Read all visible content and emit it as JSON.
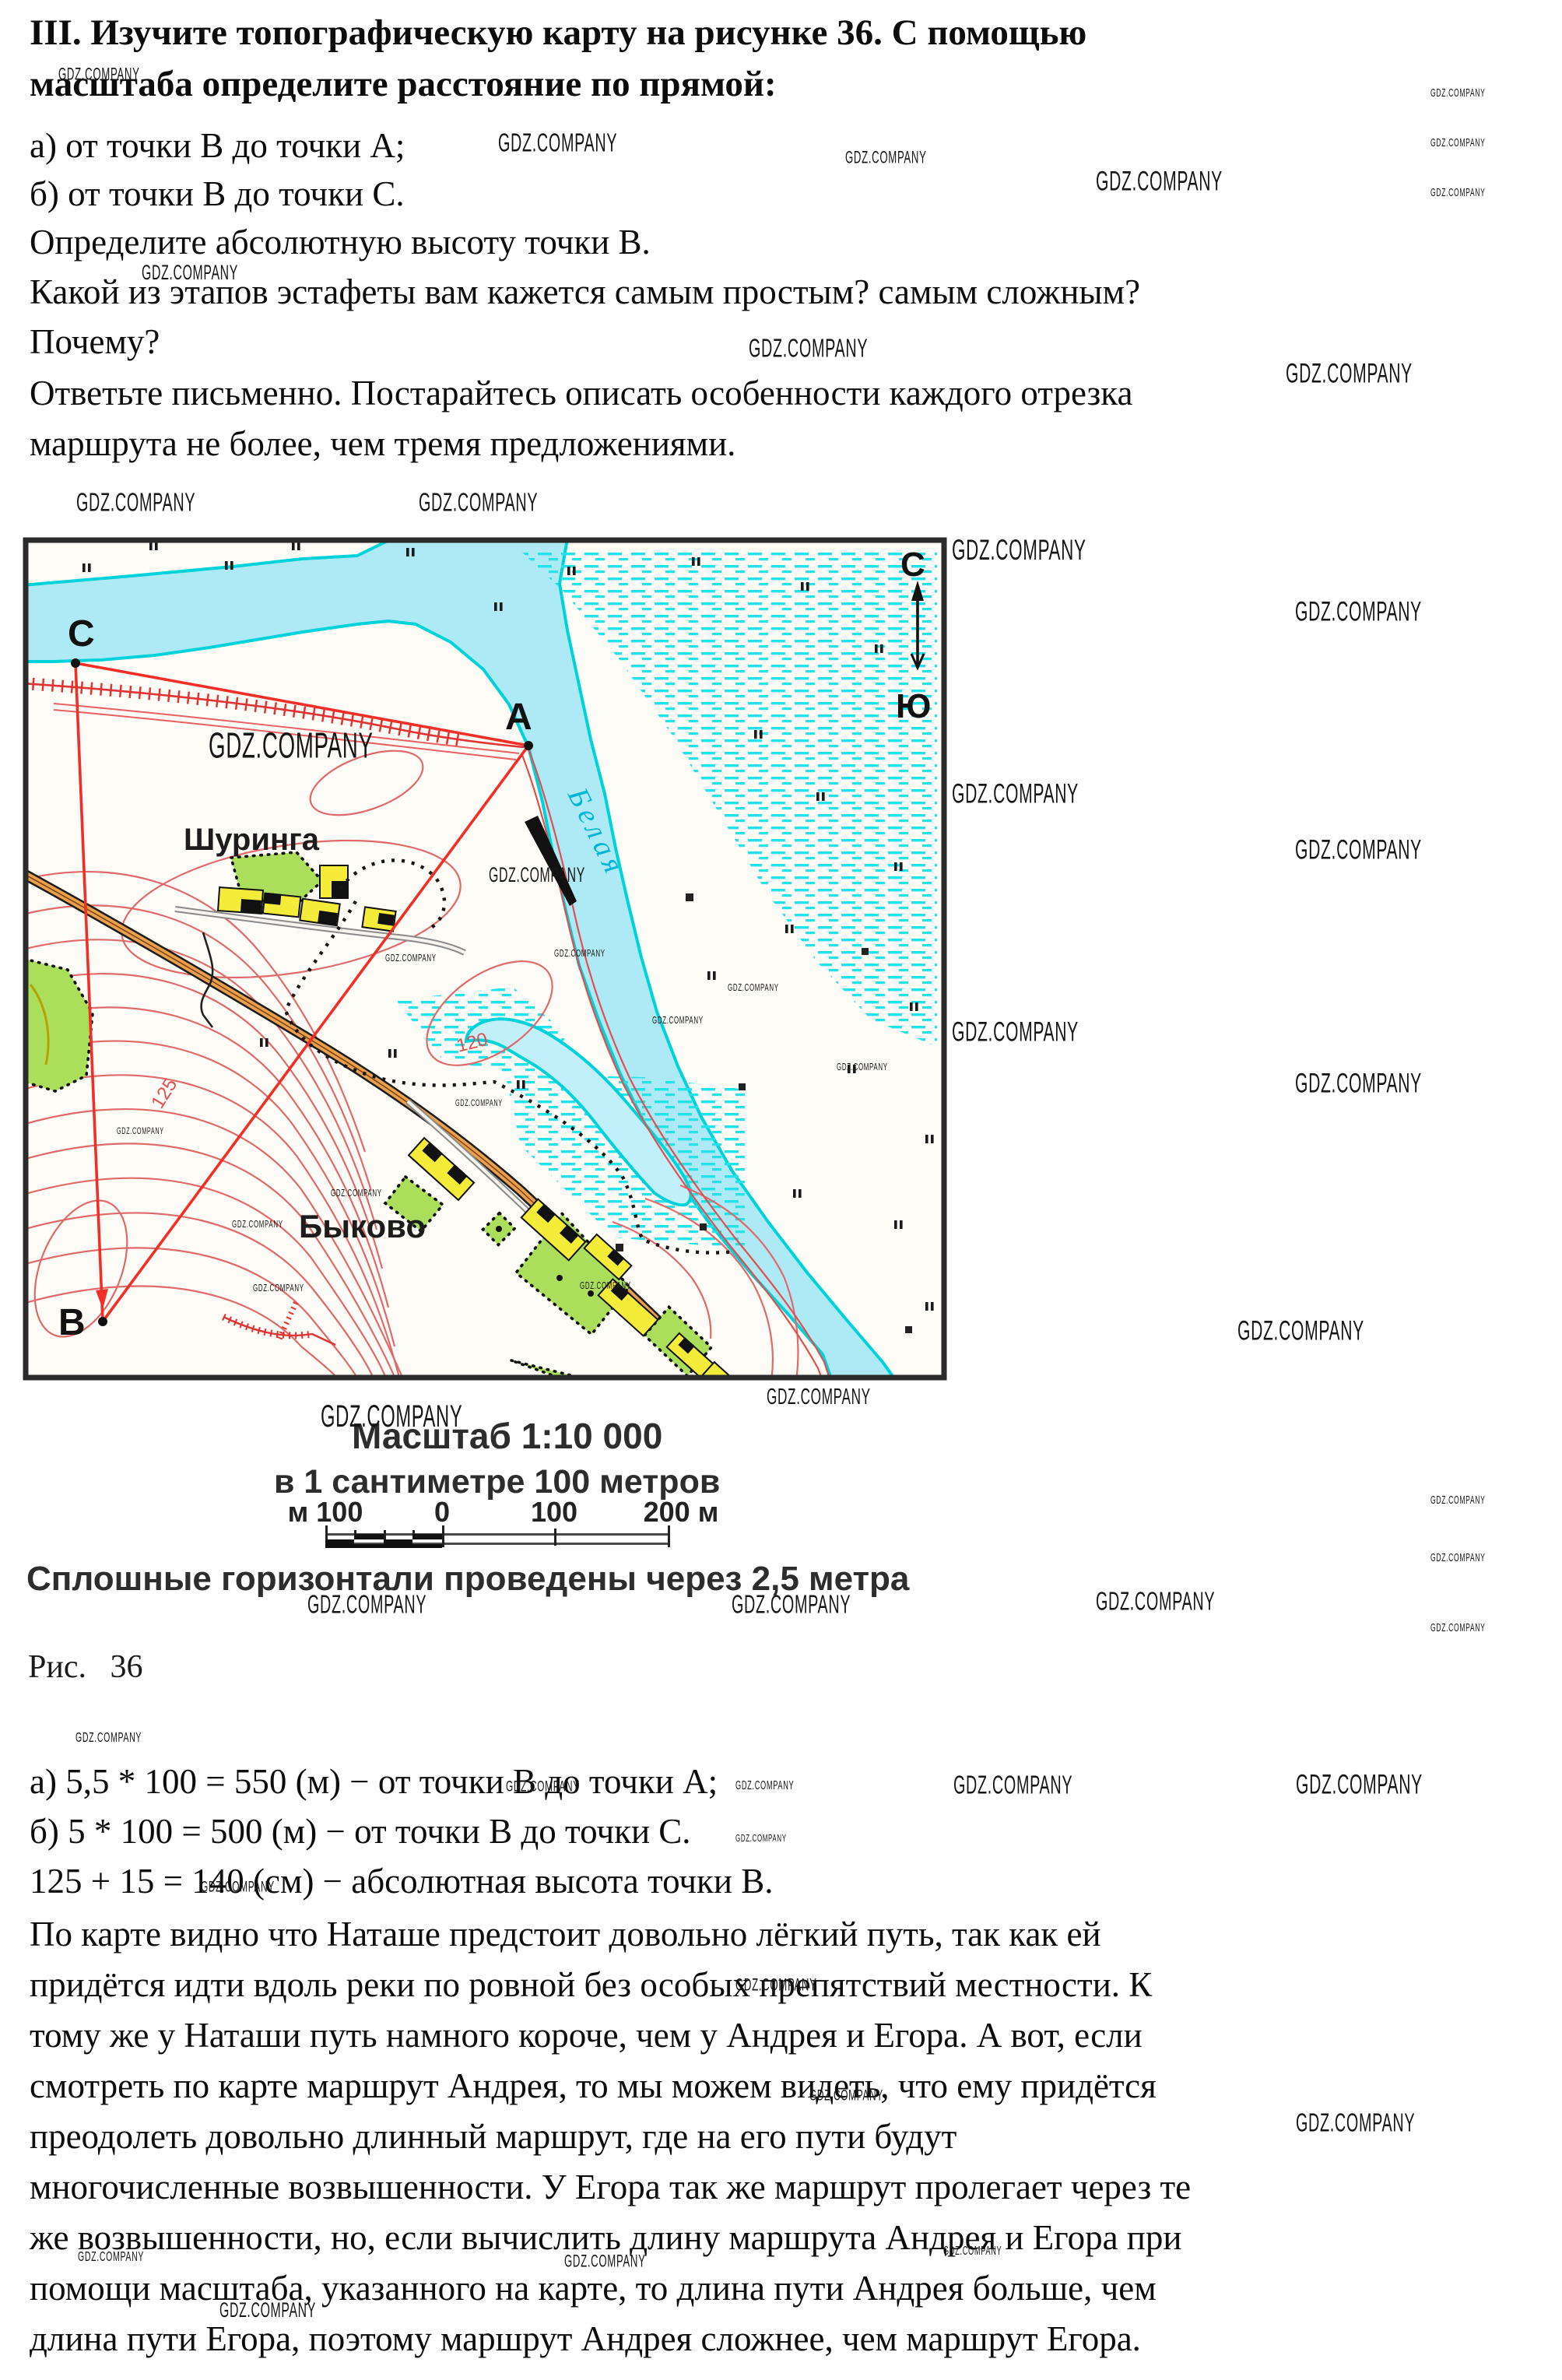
{
  "watermark": "GDZ.COMPANY",
  "task": {
    "line1": "III. Изучите топографическую карту на рисунке 36. С помощью",
    "line2": "масштаба определите расстояние по прямой:",
    "line3": "а) от точки В до точки А;",
    "line4": "б) от точки В до точки С.",
    "line5": "Определите абсолютную высоту точки В.",
    "line6": "Какой из этапов эстафеты вам кажется самым простым? самым сложным?",
    "line7": "Почему?",
    "line8": "Ответьте письменно. Постарайтесь описать особенности каждого отрезка",
    "line9": "маршрута не более, чем тремя предложениями."
  },
  "map": {
    "village_top": "Шуринга",
    "village_bottom": "Быково",
    "river_name": "Белая",
    "point_a": "A",
    "point_b": "В",
    "point_c": "С",
    "north": "С",
    "south": "Ю",
    "contour_120": "120",
    "contour_125": "125"
  },
  "caption": {
    "scale_title": "Масштаб 1:10 000",
    "scale_sub": "в 1 сантиметре 100 метров",
    "bar_left": "м 100",
    "bar_zero": "0",
    "bar_100": "100",
    "bar_200": "200 м",
    "contour_note": "Сплошные горизонтали проведены через 2,5 метра",
    "figure": "Рис. 36"
  },
  "answer": {
    "line_a": "а) 5,5 * 100 = 550 (м) − от точки В до точки А;",
    "line_b": "б) 5 * 100 = 500 (м) − от точки В до точки С.",
    "line_h": "125 + 15 = 140 (см) − абсолютная высота точки В.",
    "p1": "По карте видно что Наташе предстоит довольно лёгкий путь, так как ей",
    "p2": "придётся идти вдоль реки по ровной без особых препятствий местности. К",
    "p3": "тому же у Наташи путь намного короче, чем у Андрея и Егора. А вот, если",
    "p4": "смотреть по карте маршрут Андрея, то мы можем видеть, что ему придётся",
    "p5": "преодолеть довольно длинный маршрут, где на его пути будут",
    "p6": "многочисленные возвышенности. У Егора так же маршрут пролегает через те",
    "p7": "же возвышенности, но, если вычислить длину маршрута Андрея и Егора при",
    "p8": "помощи масштаба, указанного на карте, то длина пути Андрея больше, чем",
    "p9": "длина пути Егора, поэтому маршрут Андрея сложнее, чем маршрут Егора."
  }
}
